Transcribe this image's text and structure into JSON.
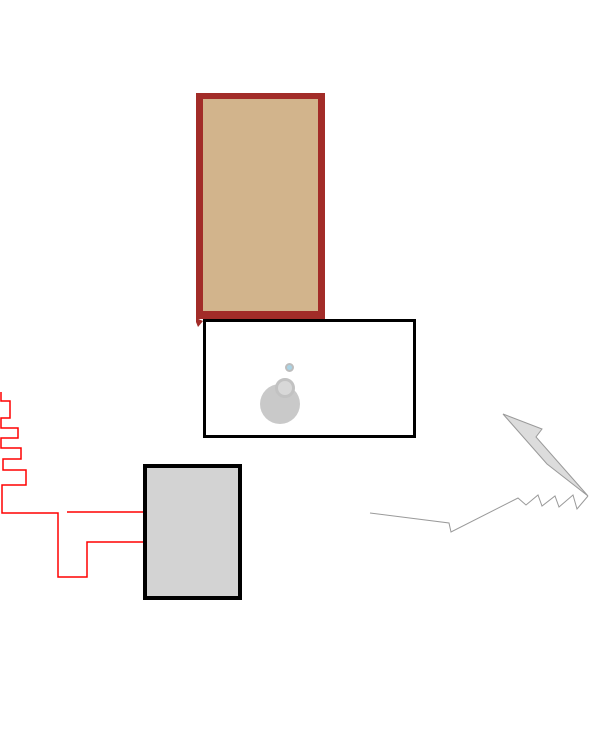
{
  "canvas": {
    "width": 612,
    "height": 736,
    "background": "#ffffff"
  },
  "palette": {
    "dark_red": "#a22c28",
    "tan": "#d2b48c",
    "black": "#000000",
    "white": "#ffffff",
    "light_gray_fill": "#d3d3d3",
    "blob_gray": "#c9c9c9",
    "blob_light_gray": "#d8d8d8",
    "blob_ring_gray": "#bdbdbd",
    "light_blue": "#a9d3e5",
    "red_line": "#ff0000",
    "arrow_gray_stroke": "#9a9a9a",
    "arrow_gray_fill": "#dcdcdc"
  },
  "shapes": {
    "tan_rectangle": {
      "x": 196,
      "y": 93,
      "width": 129,
      "height": 226,
      "fill": "#d2b48c",
      "border": {
        "top": 6,
        "right": 7,
        "bottom": 8,
        "left": 7,
        "color": "#a22c28"
      }
    },
    "tan_rectangle_corner_overshoot": {
      "points": "196,318 203,321 198,327 196,322",
      "fill": "#a22c28"
    },
    "white_rectangle": {
      "x": 203,
      "y": 319,
      "width": 213,
      "height": 119,
      "fill": "#ffffff",
      "border": {
        "top": 3,
        "right": 3,
        "bottom": 3,
        "left": 3,
        "color": "#000000"
      }
    },
    "gray_rectangle": {
      "x": 143,
      "y": 464,
      "width": 99,
      "height": 136,
      "fill": "#d3d3d3",
      "border": {
        "top": 4,
        "right": 4,
        "bottom": 4,
        "left": 4,
        "color": "#000000"
      }
    },
    "blob_large_circle": {
      "x": 260,
      "y": 384,
      "width": 40,
      "height": 40,
      "fill": "#c9c9c9",
      "border": {
        "top": 0,
        "right": 0,
        "bottom": 0,
        "left": 0,
        "color": "#c9c9c9"
      }
    },
    "blob_medium_circle": {
      "x": 275,
      "y": 378,
      "width": 20,
      "height": 20,
      "fill": "#d8d8d8",
      "border": {
        "top": 3,
        "right": 3,
        "bottom": 3,
        "left": 3,
        "color": "#c2c2c2"
      }
    },
    "blob_small_circle": {
      "x": 285,
      "y": 363,
      "width": 9,
      "height": 9,
      "fill": "#a9d3e5",
      "border": {
        "top": 2,
        "right": 2,
        "bottom": 2,
        "left": 2,
        "color": "#bdbdbd"
      }
    },
    "red_staircase_line": {
      "points": "1,392 1,401 10,401 10,418 1,418 1,428 18,428 18,438 1,438 1,448 21,448 21,459 3,459 3,470 26,470 26,485 2,485 2,513 58,513 58,577 87,577 87,542 143,542",
      "stroke": "#ff0000",
      "stroke_width": 1.5
    },
    "red_branch_line": {
      "points": "67,512 143,512",
      "stroke": "#ff0000",
      "stroke_width": 1.5
    },
    "arrow_head": {
      "points": "503,414 542,429 536,437 588,496 547,464",
      "fill": "#dcdcdc",
      "stroke": "#9a9a9a",
      "stroke_width": 1
    },
    "arrow_zigzag_tail": {
      "points": "370,513 449,523 451,532 518,498 526,505 538,495 542,506 555,496 559,507 573,495 577,509 588,496",
      "stroke": "#9a9a9a",
      "stroke_width": 1
    }
  }
}
